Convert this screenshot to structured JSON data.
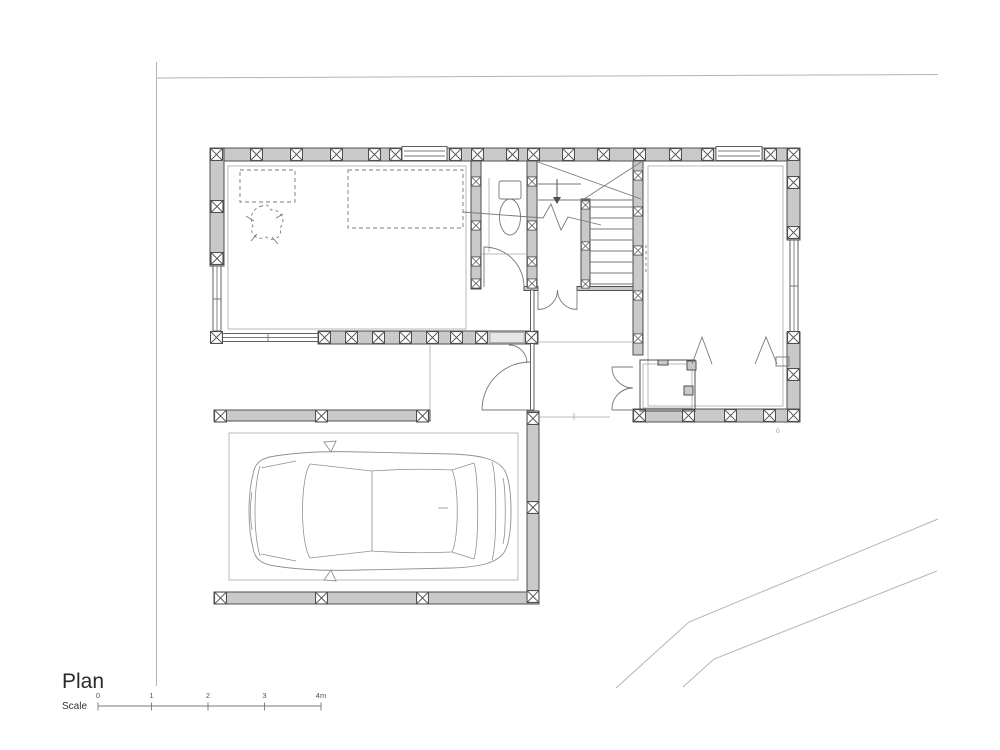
{
  "sheet": {
    "background": "#ffffff"
  },
  "title": {
    "label": "Plan"
  },
  "scale_bar": {
    "label": "Scale",
    "ticks": [
      "0",
      "1",
      "2",
      "3",
      "4m"
    ]
  },
  "site": {
    "corner_mark": "0"
  },
  "drawing": {
    "type": "architectural-floor-plan",
    "elements": [
      "site-boundary",
      "house-ground-floor",
      "entry-porch",
      "staircase",
      "bathroom-wc",
      "storage-room",
      "carport",
      "car-top-view",
      "dashed-furniture"
    ],
    "colors": {
      "wall_fill": "#c9c9c9",
      "wall_line": "#4f4f4f",
      "light_line": "#a8a8a8",
      "site_line": "#b5b5b5",
      "text": "#2a2a2a"
    }
  }
}
